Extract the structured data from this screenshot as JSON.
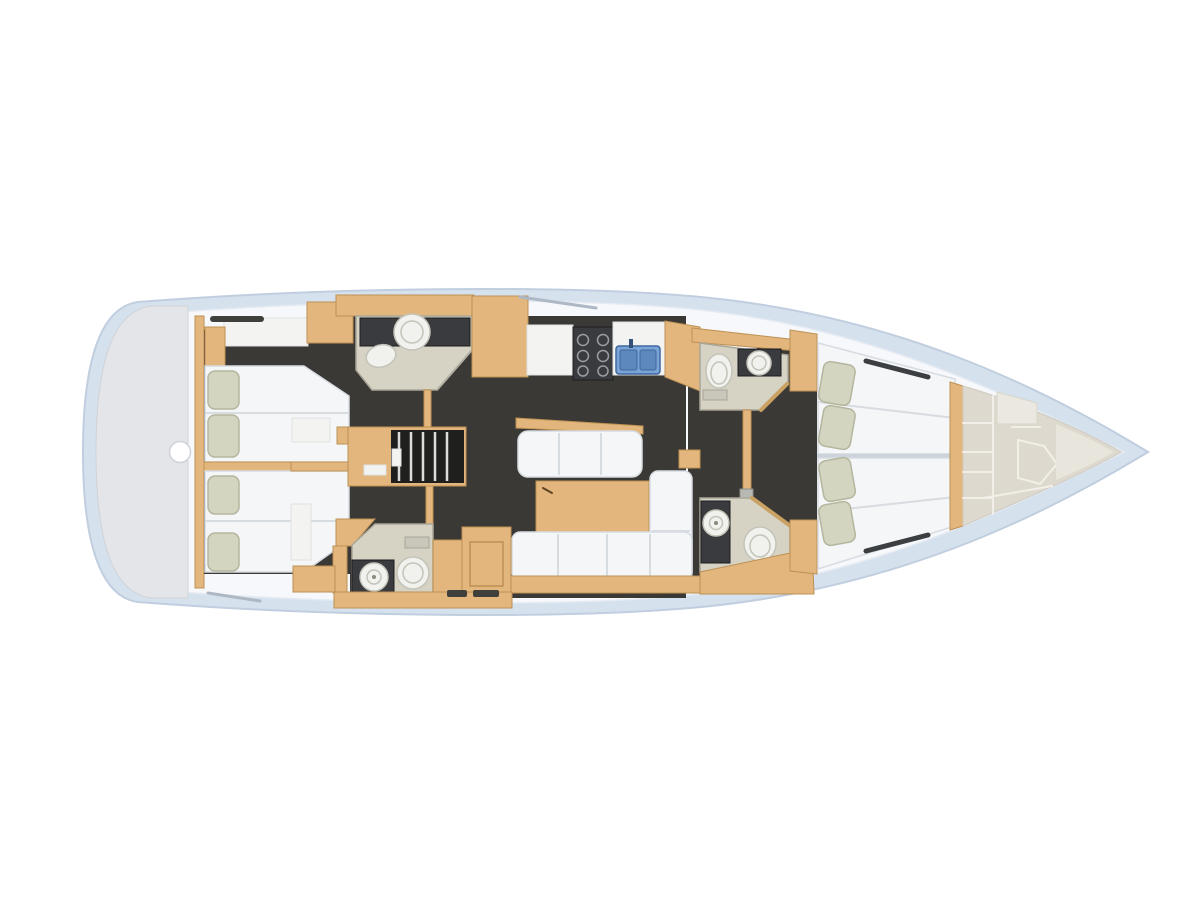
{
  "meta": {
    "title": "Sailing yacht interior floor plan - top view",
    "view": "overhead deck plan, bow pointing right"
  },
  "palette": {
    "hull": "#d6e1ee",
    "hullStroke": "#c0cedf",
    "deck": "#f6f8fb",
    "deckStroke": "#e4eaf2",
    "platform": "#e4e5e8",
    "platformStroke": "#cfd2d7",
    "wood": "#e2b67c",
    "woodStroke": "#bd9154",
    "floorDark": "#3b3936",
    "stairsDark": "#1f1f1e",
    "slat": "#dcdcd8",
    "mattress": "#f4f6f8",
    "mattressStroke": "#d7dce1",
    "pillow": "#d4d5c0",
    "pillowStroke": "#b5b69e",
    "headFloor": "#d6d3c5",
    "headFloorStroke": "#a9a698",
    "fixture": "#f1f2ee",
    "fixtureStroke": "#c3c3b9",
    "counterDark": "#3a3b3e",
    "sinkBlue": "#7aa4d8",
    "sinkBasin": "#5d88bd",
    "sinkBlueStroke": "#40689c",
    "bowFloor": "#ded9cf",
    "bowFloorStroke": "#cfcabf",
    "bowFloorLight": "#e8e5dc",
    "bowLine": "#f1efe8",
    "partition": "#eae8e0",
    "partitionStroke": "#d8d5c9",
    "railDark": "#3c3f42",
    "hatchLine": "#aeb8c4",
    "panelWhite": "#f3f4f2",
    "panelWhiteStroke": "#dfe1e0",
    "slotDark": "#3f403b",
    "doorWood": "#caa263",
    "grille": "#c9c6ba",
    "grilleStroke": "#a8a699",
    "metal": "#b9b9b3",
    "centerline": "#ccd3da"
  },
  "rooms": [
    {
      "id": "stern-platform",
      "label": "stern swim platform"
    },
    {
      "id": "aft-cabin-port",
      "label": "aft double cabin, port side"
    },
    {
      "id": "aft-cabin-starboard",
      "label": "aft double cabin, starboard side"
    },
    {
      "id": "head-aft-port",
      "label": "aft head with washbasin and toilet"
    },
    {
      "id": "head-aft-starboard",
      "label": "aft head with shower and toilet"
    },
    {
      "id": "companionway",
      "label": "companionway steps"
    },
    {
      "id": "galley",
      "label": "galley with stove and double sink"
    },
    {
      "id": "salon",
      "label": "salon with dining table and L-shaped sofa"
    },
    {
      "id": "head-fwd-port",
      "label": "forward head with washbasin and toilet"
    },
    {
      "id": "head-fwd-starboard",
      "label": "forward head with shower and toilet"
    },
    {
      "id": "fwd-cabin-port",
      "label": "forward double cabin, port side"
    },
    {
      "id": "fwd-cabin-starboard",
      "label": "forward double cabin, starboard side"
    },
    {
      "id": "bow-locker",
      "label": "bow sail locker"
    }
  ]
}
